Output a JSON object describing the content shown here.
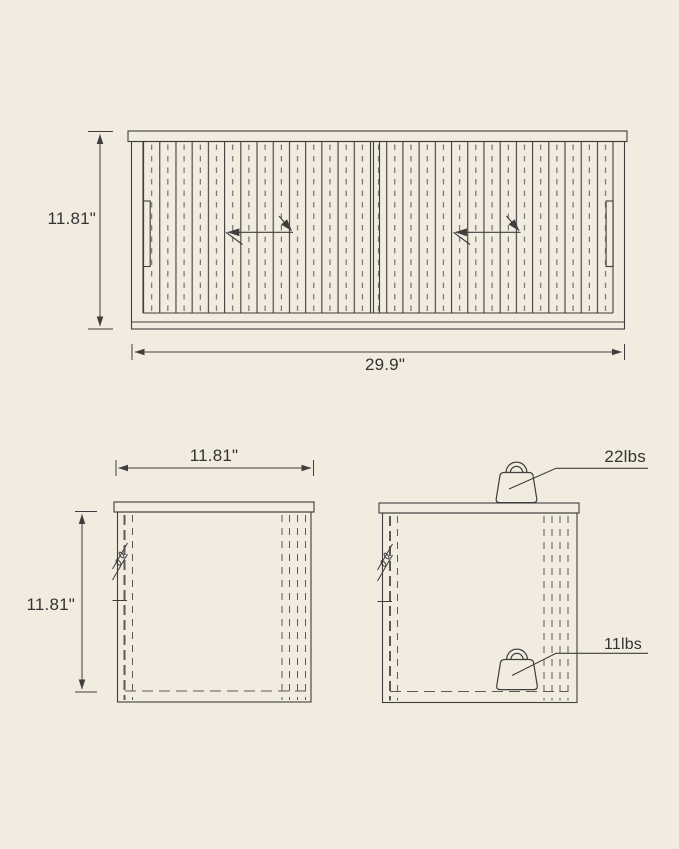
{
  "colors": {
    "background": "#f1ecdf",
    "line": "#3e3e3e",
    "dashed_line": "#5a5a5a",
    "text": "#333333"
  },
  "front_view": {
    "height_label": "11.81\"",
    "width_label": "29.9\""
  },
  "side_view": {
    "width_label": "11.81\"",
    "height_label": "11.81\""
  },
  "load_view": {
    "top_load_label": "22lbs",
    "shelf_load_label": "11lbs"
  },
  "icons": {
    "top_weight": "weight-icon",
    "shelf_weight": "weight-icon",
    "door_arrows": "slide-direction-arrow-icon"
  }
}
